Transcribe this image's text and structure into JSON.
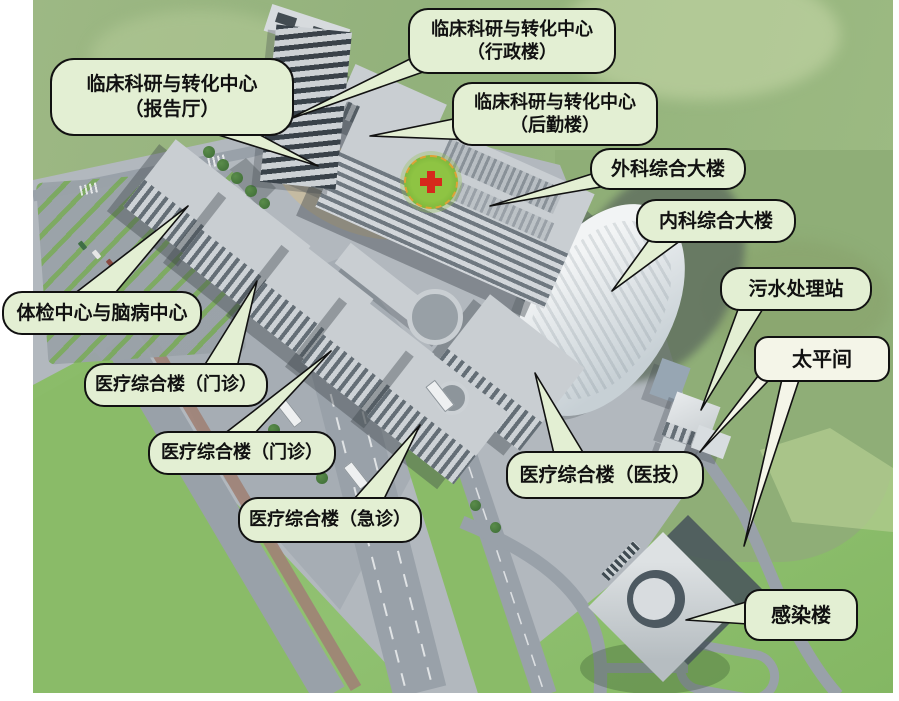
{
  "meta": {
    "title": "医院园区鸟瞰效果图（楼宇标注）",
    "type": "3d-aerial-architectural-rendering",
    "canvas": {
      "width": 899,
      "height": 701
    }
  },
  "scene": {
    "colors": {
      "bubble_fill": "#e3efd3",
      "bubble_fill_alt": "#f4f5e8",
      "bubble_border": "#111111",
      "label_text": "#111111",
      "hill_green": "#94b27c",
      "hill_light": "#b3cd92",
      "grass_green": "#8abb68",
      "campus_gray": "#b2b8be",
      "plaza_gray": "#a6adb4",
      "road_gray": "#99a1a9",
      "path_brown": "#a08275",
      "building_top": "#c9ced2",
      "building_face": "#5f6971",
      "shadow": "#3e4a50",
      "oval_glass_white": "#eef1f3",
      "helipad_green": "#7fbb3c",
      "helipad_ring_orange": "#dda335",
      "helipad_cross_red": "#d6281c",
      "tree_green": "#3c6b35"
    },
    "features": [
      {
        "name": "helipad",
        "description": "屋顶停机坪：绿色圆形带橙色虚线环与红十字"
      },
      {
        "name": "curved-glass-building",
        "description": "椭圆形玻璃大楼（内科综合大楼）"
      },
      {
        "name": "infection-building",
        "description": "独立的旋转方形建筑，中部圆形庭院"
      }
    ]
  },
  "callouts": [
    {
      "id": "admin",
      "line1": "临床科研与转化中心",
      "line2": "（行政楼）"
    },
    {
      "id": "lecture-hall",
      "line1": "临床科研与转化中心",
      "line2": "（报告厅）"
    },
    {
      "id": "logistics",
      "line1": "临床科研与转化中心",
      "line2": "（后勤楼）"
    },
    {
      "id": "surgery-building",
      "line1": "外科综合大楼"
    },
    {
      "id": "internal-medicine",
      "line1": "内科综合大楼"
    },
    {
      "id": "sewage-station",
      "line1": "污水处理站"
    },
    {
      "id": "morgue",
      "line1": "太平间"
    },
    {
      "id": "checkup-center",
      "line1": "体检中心与脑病中心"
    },
    {
      "id": "outpatient-1",
      "line1": "医疗综合楼（门诊）"
    },
    {
      "id": "outpatient-2",
      "line1": "医疗综合楼（门诊）"
    },
    {
      "id": "emergency",
      "line1": "医疗综合楼（急诊）"
    },
    {
      "id": "med-tech",
      "line1": "医疗综合楼（医技）"
    },
    {
      "id": "infection",
      "line1": "感染楼"
    }
  ]
}
